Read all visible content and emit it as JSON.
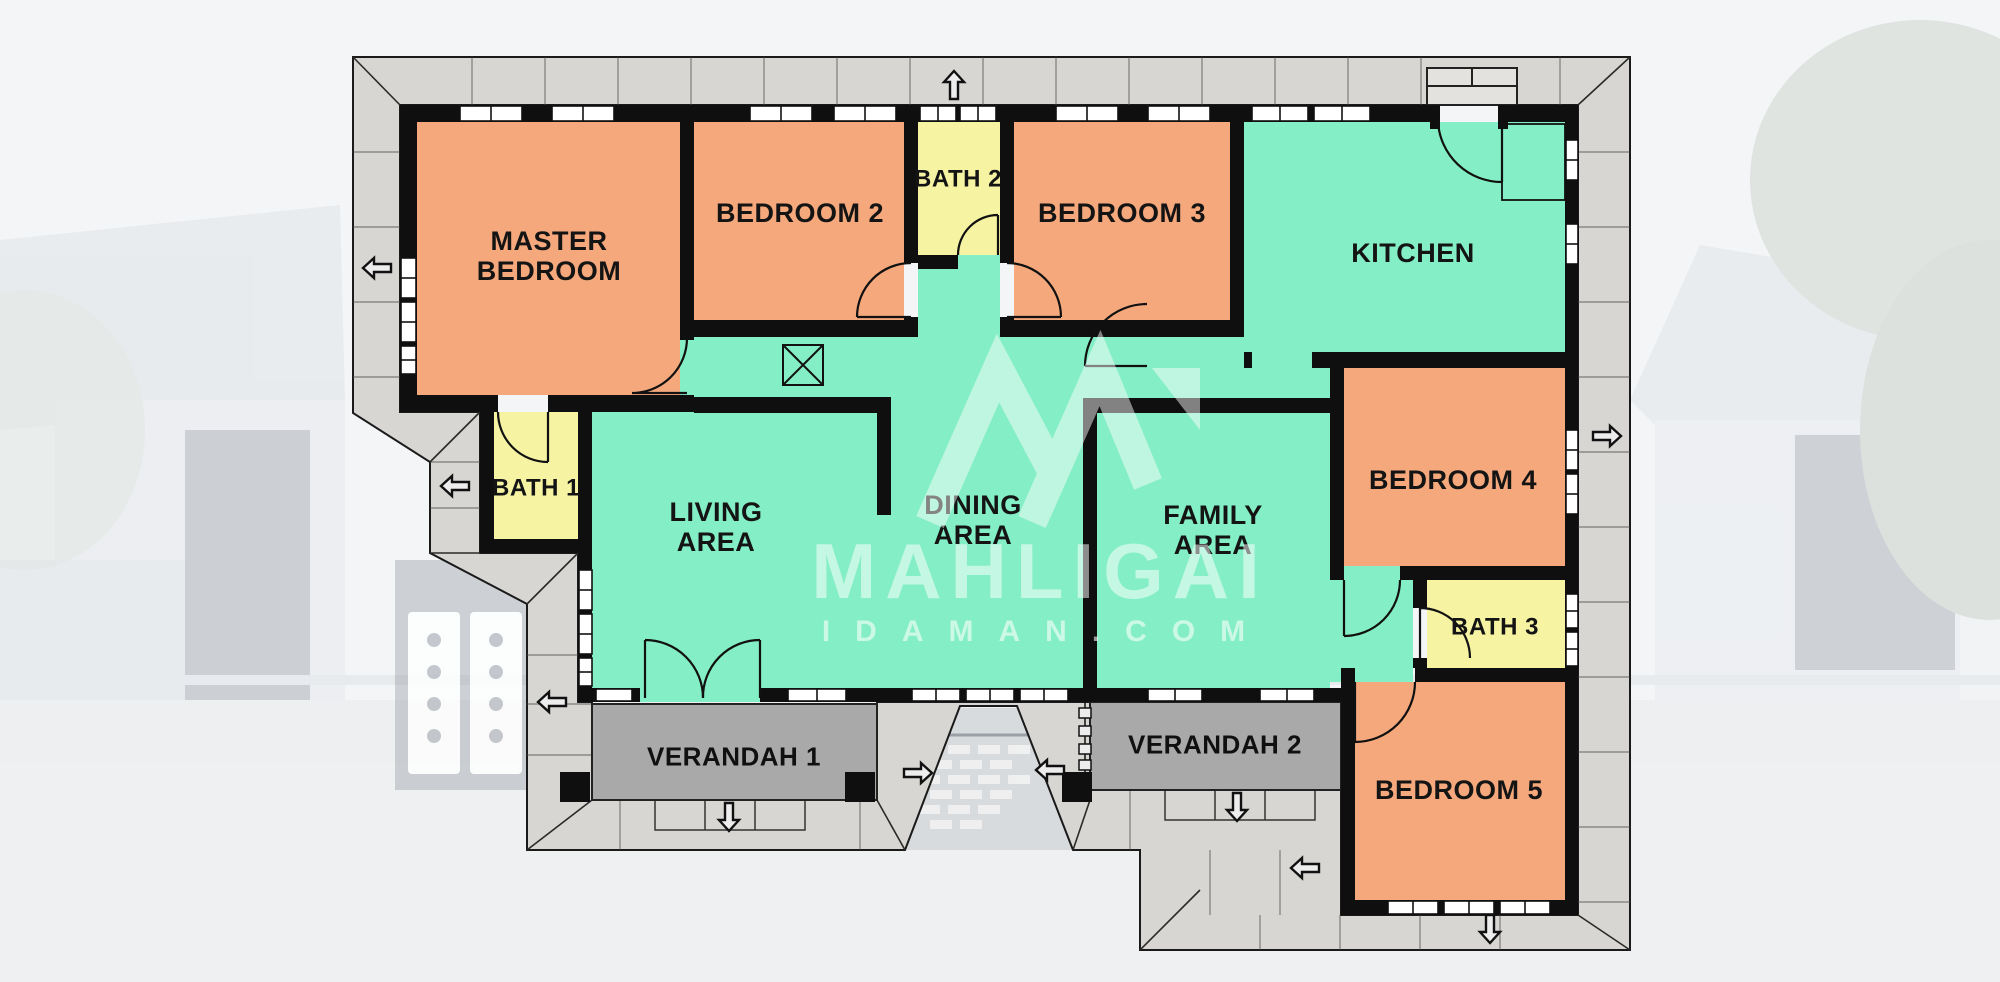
{
  "scene": {
    "type": "house-floor-plan",
    "description": "Single-storey 5-bedroom bungalow floor plan overlaid on a faded photo of the house"
  },
  "watermark": {
    "brand": "MAHLIGAI",
    "domain": "IDAMAN.COM",
    "logo": "m-monogram"
  },
  "rooms": [
    {
      "id": "master-bedroom",
      "label": "MASTER BEDROOM",
      "category": "bedroom"
    },
    {
      "id": "bedroom-2",
      "label": "BEDROOM 2",
      "category": "bedroom"
    },
    {
      "id": "bath-2",
      "label": "BATH 2",
      "category": "bath"
    },
    {
      "id": "bedroom-3",
      "label": "BEDROOM 3",
      "category": "bedroom"
    },
    {
      "id": "kitchen",
      "label": "KITCHEN",
      "category": "common"
    },
    {
      "id": "bath-1",
      "label": "BATH 1",
      "category": "bath"
    },
    {
      "id": "living-area",
      "label": "LIVING AREA",
      "category": "common"
    },
    {
      "id": "dining-area",
      "label": "DINING AREA",
      "category": "common"
    },
    {
      "id": "family-area",
      "label": "FAMILY AREA",
      "category": "common"
    },
    {
      "id": "bedroom-4",
      "label": "BEDROOM 4",
      "category": "bedroom"
    },
    {
      "id": "bath-3",
      "label": "BATH 3",
      "category": "bath"
    },
    {
      "id": "bedroom-5",
      "label": "BEDROOM 5",
      "category": "bedroom"
    },
    {
      "id": "verandah-1",
      "label": "VERANDAH 1",
      "category": "verandah"
    },
    {
      "id": "verandah-2",
      "label": "VERANDAH 2",
      "category": "verandah"
    }
  ],
  "legend_colors": {
    "bedroom": "#f4a87c",
    "bath": "#f6f3a3",
    "common": "#84eec6",
    "verandah": "#a9a9a9",
    "walkway": "#d8d6d2",
    "wall": "#0f0f0f"
  },
  "arrows": {
    "directions": [
      "up",
      "left",
      "left",
      "left",
      "right",
      "left",
      "right",
      "left",
      "down",
      "down",
      "down"
    ]
  }
}
